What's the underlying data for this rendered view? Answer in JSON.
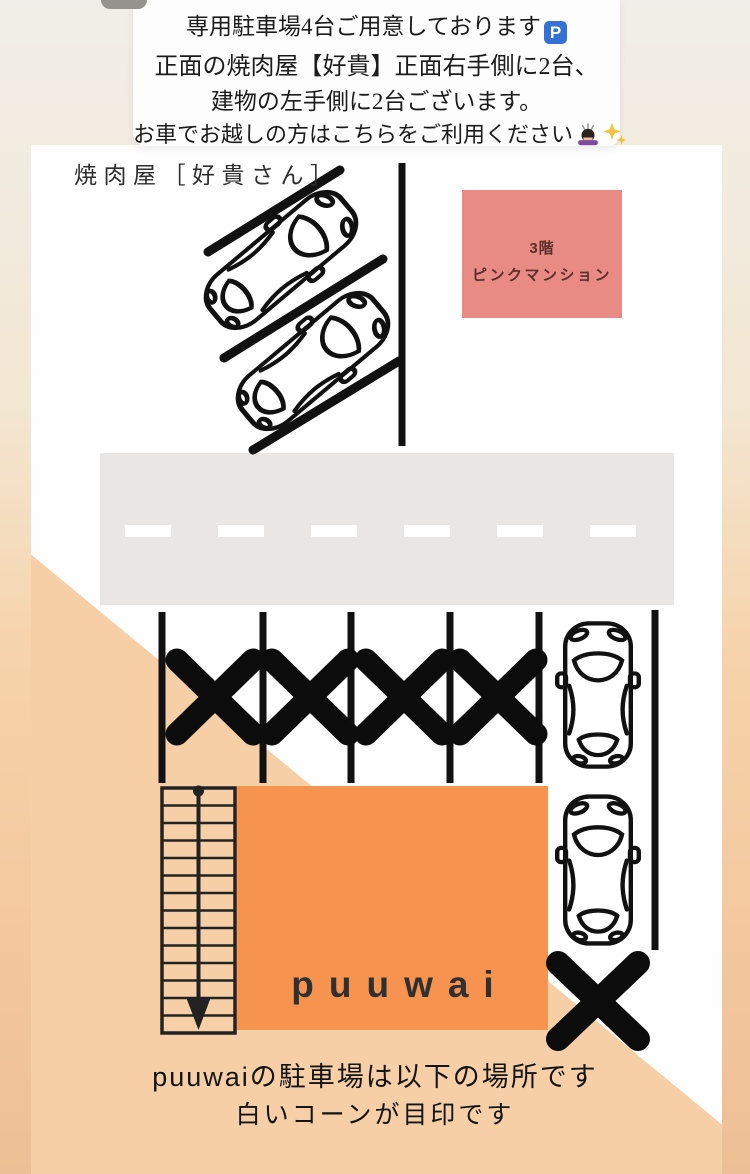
{
  "notice": {
    "line1": "専用駐車場4台ご用意しております",
    "line2": "正面の焼肉屋【好貴】正面右手側に2台、",
    "line3": "建物の左手側に2台ございます。",
    "line4": "お車でお越しの方はこちらをご利用ください",
    "parking_badge": "P"
  },
  "map": {
    "yakiniku_label": "焼肉屋［好貴さん］",
    "pink_building": {
      "floor": "3階",
      "name": "ピンクマンション"
    },
    "building_label": "puuwai",
    "upper_angled_cars_count": 2,
    "right_column_cars_count": 2,
    "blocked_spot_x_marks_count": 5,
    "road_dash_count": 6
  },
  "footer": {
    "line1": "puuwaiの駐車場は以下の場所です",
    "line2": "白いコーンが目印です"
  },
  "colors": {
    "peach": "#f6cfa6",
    "road_gray": "#e8e7e5",
    "building_orange": "#f6934e",
    "mansion_pink": "#e98b85",
    "mansion_text": "#5c2e28",
    "line_black": "#111111",
    "parking_badge_blue": "#3570d4"
  },
  "icons": {
    "parking_sign": "parking-sign-icon",
    "bowing_person": "bowing-person-icon",
    "sparkles": "sparkles-icon",
    "car_top_view": "car-top-view-icon",
    "cross_mark": "cross-mark-icon",
    "stairs": "stairs-down-arrow-icon"
  }
}
